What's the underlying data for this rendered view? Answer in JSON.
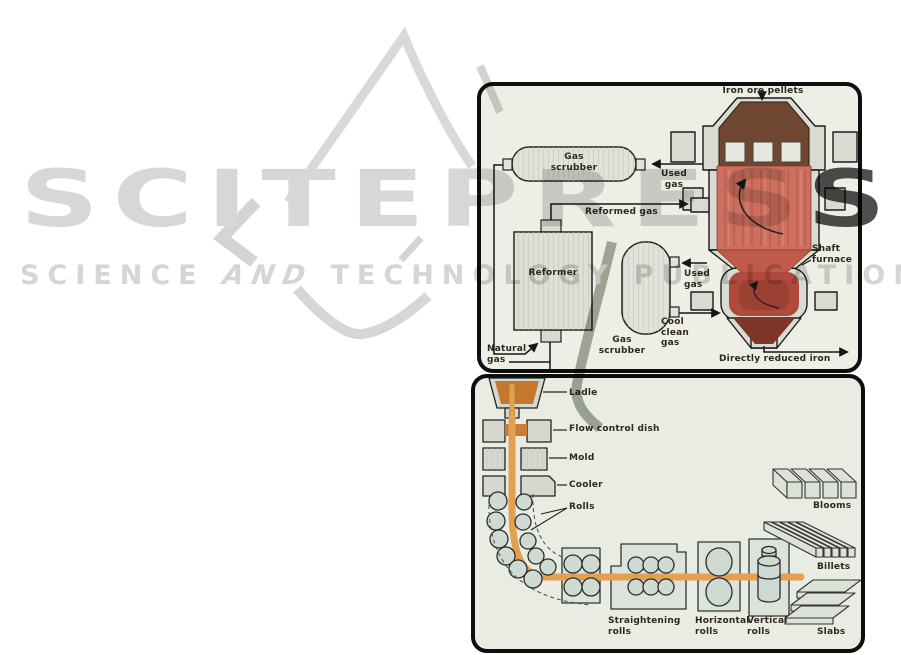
{
  "watermark": {
    "brand_main": "SCITEPRES",
    "brand_last": "S",
    "tagline_word1": "SCIENCE",
    "tagline_word2": "AND",
    "tagline_word3": "TECHNOLOGY",
    "tagline_word4": "PUBLICATIONS",
    "light_color": "#d7d7d7",
    "dark_color": "#4e4e4e"
  },
  "figure_top": {
    "labels": {
      "iron_ore_pellets": "Iron ore pellets",
      "gas_scrubber_top": "Gas\nscrubber",
      "used_gas_upper": "Used\ngas",
      "reformed_gas": "Reformed gas",
      "reformer": "Reformer",
      "shaft_furnace": "Shaft\nfurnace",
      "used_gas_lower": "Used\ngas",
      "gas_scrubber_bottom": "Gas\nscrubber",
      "cool_clean_gas": "Cool\nclean\ngas",
      "natural_gas": "Natural\ngas",
      "directly_reduced_iron": "Directly reduced iron"
    }
  },
  "figure_bottom": {
    "labels": {
      "ladle": "Ladle",
      "flow_control_dish": "Flow control dish",
      "mold": "Mold",
      "cooler": "Cooler",
      "rolls": "Rolls",
      "straightening_rolls": "Straightening\nrolls",
      "horizontal_rolls": "Horizontal\nrolls",
      "vertical_rolls": "Vertical\nrolls",
      "blooms": "Blooms",
      "billets": "Billets",
      "slabs": "Slabs"
    }
  },
  "colors": {
    "figure_background_top": "#edefe6",
    "figure_background_bottom": "#e9ece3",
    "machine_gray": "#d8dbd2",
    "furnace_red": "#cd6f60",
    "furnace_ore_brown": "#6f4730",
    "furnace_cone_dark": "#7e3426",
    "strand_orange": "#e2a050",
    "melt_orange": "#c4782e",
    "line_black": "#161616"
  }
}
